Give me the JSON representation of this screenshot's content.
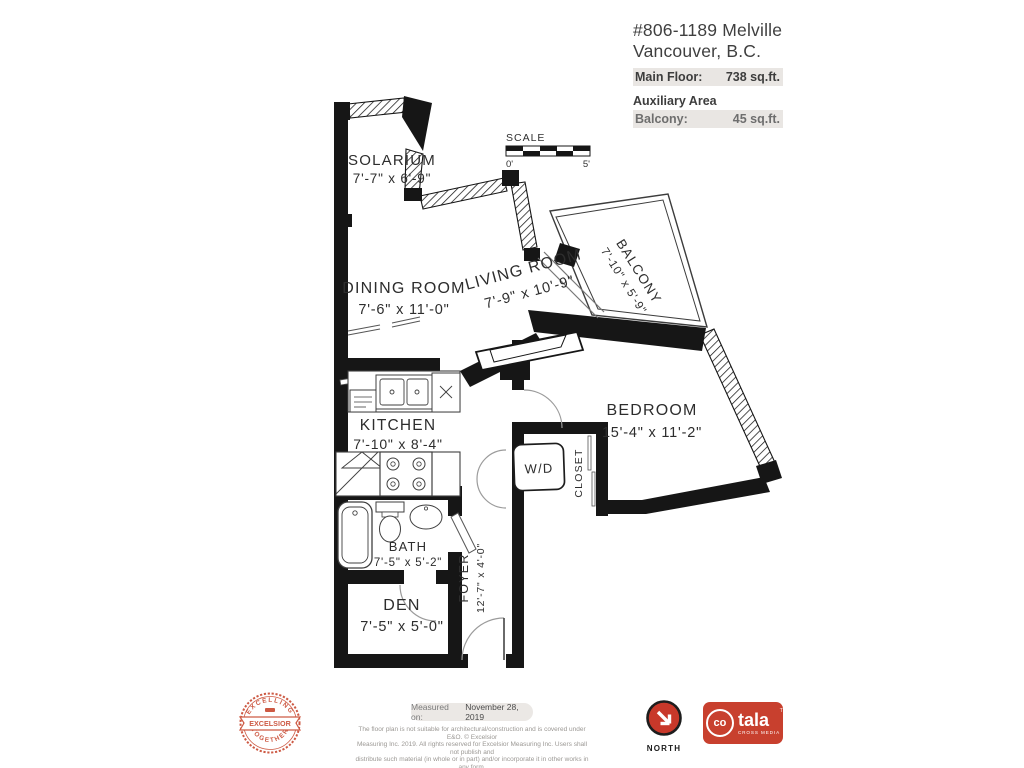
{
  "header": {
    "address_line1": "#806-1189 Melville",
    "address_line2": "Vancouver, B.C.",
    "main_floor_label": "Main Floor:",
    "main_floor_value": "738 sq.ft.",
    "aux_area_label": "Auxiliary Area",
    "balcony_label": "Balcony:",
    "balcony_value": "45 sq.ft."
  },
  "scale": {
    "label": "SCALE",
    "zero": "0'",
    "five": "5'"
  },
  "rooms": {
    "solarium": {
      "name": "SOLARIUM",
      "dims": "7'-7\" x 6'-9\""
    },
    "dining": {
      "name": "DINING ROOM",
      "dims": "7'-6\" x 11'-0\""
    },
    "living": {
      "name": "LIVING ROOM",
      "dims": "7'-9\" x 10'-9\""
    },
    "balcony": {
      "name": "BALCONY",
      "dims": "7'-10\" x 5'-9\""
    },
    "bedroom": {
      "name": "BEDROOM",
      "dims": "15'-4\" x 11'-2\""
    },
    "kitchen": {
      "name": "KITCHEN",
      "dims": "7'-10\" x 8'-4\""
    },
    "bath": {
      "name": "BATH",
      "dims": "7'-5\" x 5'-2\""
    },
    "den": {
      "name": "DEN",
      "dims": "7'-5\" x 5'-0\""
    },
    "foyer": {
      "name": "FOYER",
      "dims": "12'-7\" x 4'-0\""
    },
    "wd": {
      "name": "W/D"
    },
    "closet": {
      "name": "CLOSET"
    }
  },
  "footer": {
    "measured_label": "Measured on:",
    "measured_date": "November 28, 2019",
    "disclaimer_line1": "The floor plan is not suitable for architectural/construction and is covered under E&O. © Excelsior",
    "disclaimer_line2": "Measuring Inc. 2019. All rights reserved for Excelsior Measuring Inc. Users shall not publish and",
    "disclaimer_line3": "distribute such material (in whole or in part) and/or incorporate it in other works in any form.",
    "badge": {
      "top_text": "EXCELLING",
      "ribbon_text": "EXCELSIOR",
      "bottom_text": "TOGETHER"
    },
    "north_label": "NORTH",
    "cotala": {
      "co": "co",
      "tala": "tala",
      "tm": "TM",
      "tagline": "CROSS MEDIA"
    }
  },
  "colors": {
    "plan_ink": "#161616",
    "logo_red": "#c8402e",
    "badge_red": "#cd5a44",
    "bar_gray": "#e9e6e3"
  }
}
